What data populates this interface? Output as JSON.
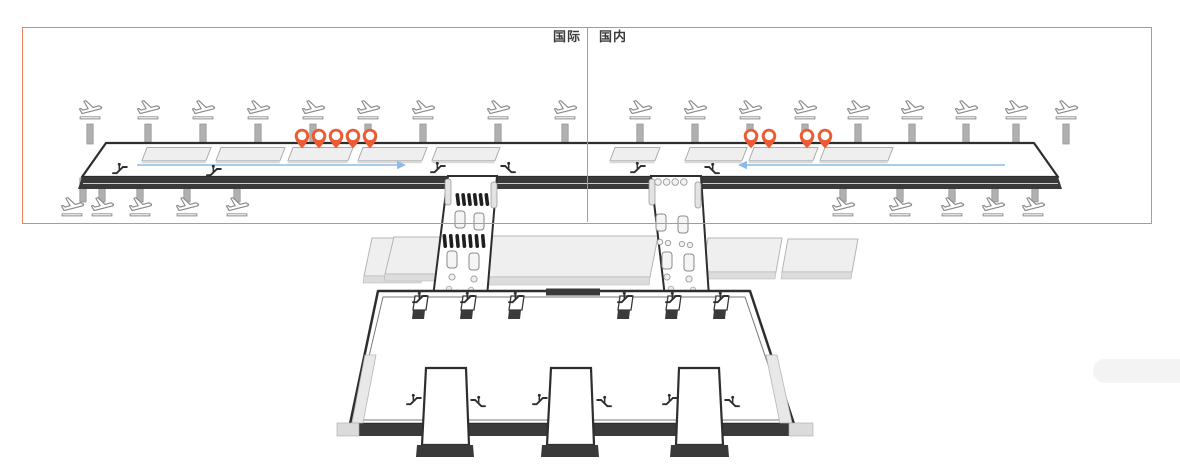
{
  "zones": {
    "box": {
      "x": 22,
      "y": 27,
      "width": 1128,
      "height": 195
    },
    "divider_x": 587,
    "international_label": "国际",
    "domestic_label": "国内"
  },
  "colors": {
    "zone_border": "#F0825F",
    "pin": "#ED5B35",
    "arrow_blue": "#8BBCE8",
    "outline_dark": "#2E2E2E",
    "band_dark": "#3A3A3A",
    "bridge_gray": "#B0B0B0",
    "slab_gray": "#EFEFEF"
  },
  "icons": {
    "plane": "airplane-departure-icon",
    "pin": "gate-pin-icon",
    "escalator": "escalator-icon",
    "bridge": "jet-bridge-stub",
    "walkway": "moving-walkway",
    "arrow": "walk-direction-arrow"
  },
  "concourse": {
    "planes_top_x": [
      90,
      148,
      203,
      258,
      313,
      368,
      423,
      498,
      565,
      640,
      695,
      750,
      805,
      858,
      912,
      966,
      1016,
      1066
    ],
    "planes_bottom_x": [
      72,
      102,
      140,
      187,
      237,
      843,
      900,
      952,
      993,
      1033
    ],
    "bridges_top_x": [
      90,
      148,
      203,
      258,
      313,
      368,
      423,
      498,
      565,
      640,
      695,
      750,
      805,
      858,
      912,
      966,
      1016,
      1066
    ],
    "bridges_bottom_x": [
      83,
      102,
      140,
      187,
      237,
      843,
      900,
      952,
      995,
      1035
    ],
    "pins_international_x": [
      302,
      319,
      336,
      353,
      370
    ],
    "pins_domestic_x": [
      751,
      769,
      807,
      825
    ],
    "walkways": [
      [
        142,
        206
      ],
      [
        216,
        280
      ],
      [
        288,
        348
      ],
      [
        358,
        422
      ],
      [
        432,
        495
      ],
      [
        610,
        655
      ],
      [
        685,
        742
      ],
      [
        749,
        813
      ],
      [
        820,
        888
      ]
    ],
    "arrows": [
      {
        "x_start": 137,
        "x_end": 406,
        "y": 165,
        "direction": "right"
      },
      {
        "x_start": 1005,
        "x_end": 738,
        "y": 165,
        "direction": "left"
      }
    ],
    "escalators": [
      {
        "x": 112,
        "y": 162,
        "flip": false
      },
      {
        "x": 206,
        "y": 164,
        "flip": false
      },
      {
        "x": 430,
        "y": 161,
        "flip": false
      },
      {
        "x": 500,
        "y": 161,
        "flip": true
      },
      {
        "x": 630,
        "y": 161,
        "flip": false
      },
      {
        "x": 704,
        "y": 162,
        "flip": true
      }
    ]
  },
  "terminal": {
    "bridges_top_x": [
      422,
      470,
      518,
      627,
      675,
      723
    ],
    "pier_escalators": [
      {
        "x": 406,
        "y": 393,
        "flip": false
      },
      {
        "x": 470,
        "y": 395,
        "flip": true
      },
      {
        "x": 532,
        "y": 393,
        "flip": false
      },
      {
        "x": 596,
        "y": 395,
        "flip": true
      },
      {
        "x": 662,
        "y": 393,
        "flip": false
      },
      {
        "x": 724,
        "y": 395,
        "flip": true
      }
    ]
  }
}
